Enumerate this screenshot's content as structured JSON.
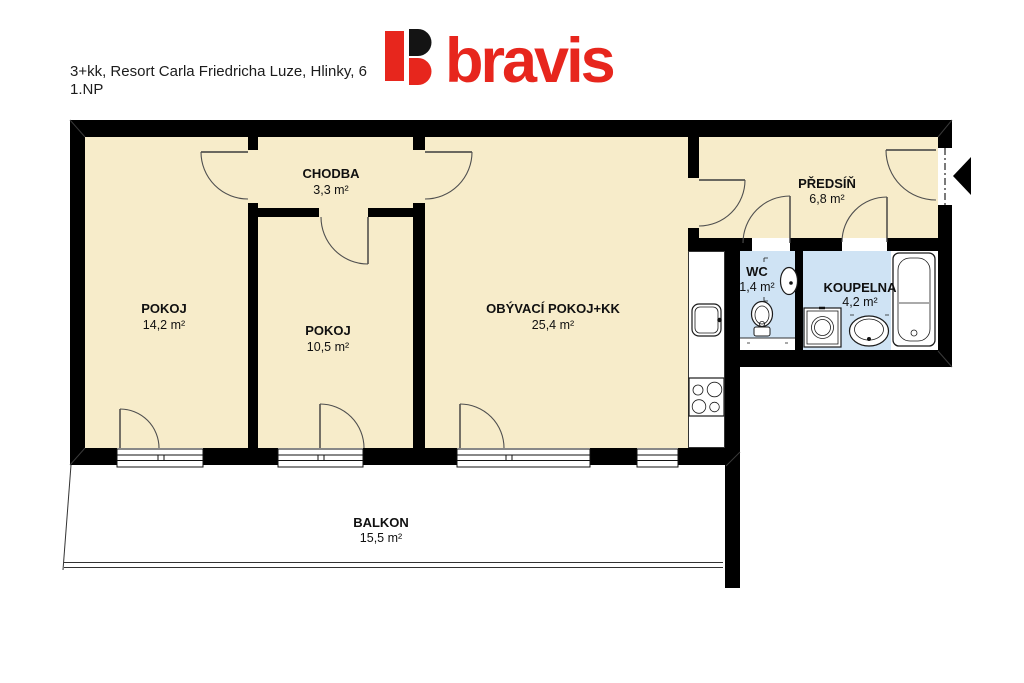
{
  "header": {
    "title_line1": "3+kk, Resort Carla Friedricha Luze, Hlinky, 6",
    "title_line2": "1.NP",
    "logo_text": "bravis"
  },
  "colors": {
    "wall": "#000000",
    "floor": "#f7ecca",
    "wet_floor": "#cfe3f4",
    "logo_red": "#e7261d",
    "logo_black": "#141414"
  },
  "rooms": [
    {
      "name": "POKOJ",
      "area": "14,2 m²"
    },
    {
      "name": "CHODBA",
      "area": "3,3 m²"
    },
    {
      "name": "POKOJ",
      "area": "10,5 m²"
    },
    {
      "name": "OBÝVACÍ POKOJ+KK",
      "area": "25,4 m²"
    },
    {
      "name": "PŘEDSÍŇ",
      "area": "6,8 m²"
    },
    {
      "name": "WC",
      "area": "1,4 m²"
    },
    {
      "name": "KOUPELNA",
      "area": "4,2 m²"
    },
    {
      "name": "BALKON",
      "area": "15,5 m²"
    }
  ]
}
